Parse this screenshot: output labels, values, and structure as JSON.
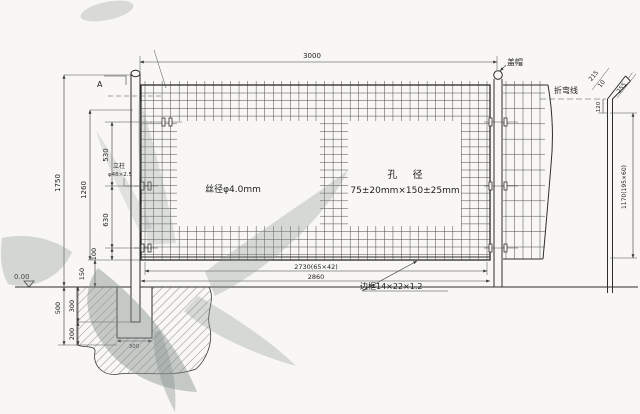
{
  "labels": {
    "cap": "盖帽",
    "bend_line": "折弯线",
    "section_marker": "A",
    "post_title": "立柱",
    "post_spec": "φ48×2.5",
    "wire_diameter": "丝径φ4.0mm",
    "aperture_title": "孔  径",
    "aperture_spec": "75±20mm×150±25mm",
    "frame_spec": "边框14×22×1.2",
    "ground_level": "0.00"
  },
  "dimensions": {
    "overall_width": "3000",
    "mesh_width": "2730(65×42)",
    "panel_width": "2860",
    "overall_height": "1750",
    "mesh_height": "1260",
    "upper_segment": "530",
    "middle_segment": "630",
    "lower_segment": "100",
    "bottom_gap": "150",
    "foundation_depth": "500",
    "embed_upper": "300",
    "embed_lower": "200",
    "pit_width": "300",
    "side_height": "1170(195×60)",
    "bend_length": "215",
    "bend_offset": "10",
    "bend_arm": "255",
    "bend_drop": "120"
  }
}
